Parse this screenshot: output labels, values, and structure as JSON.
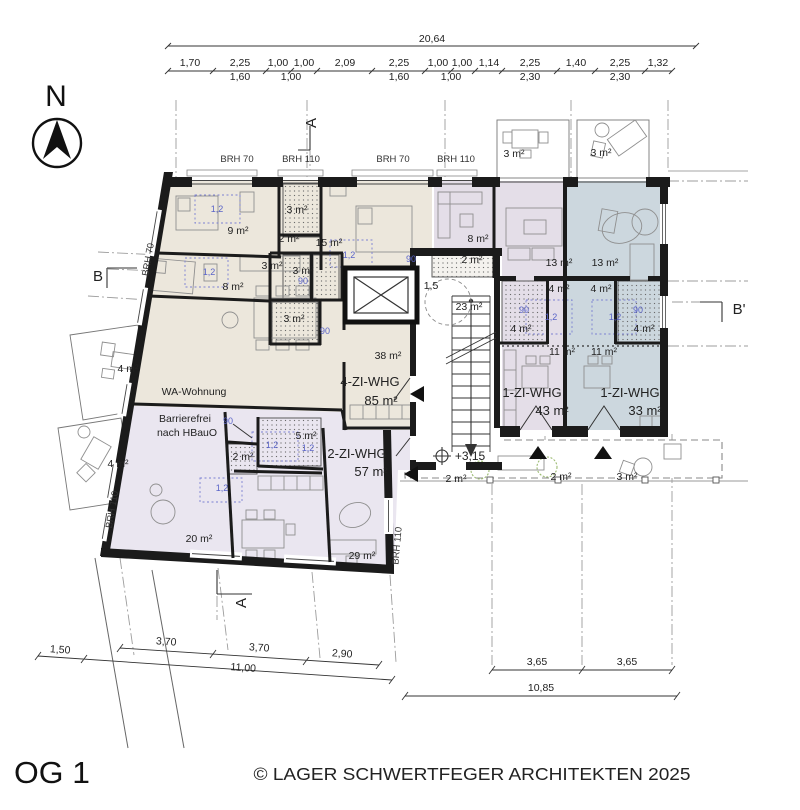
{
  "meta": {
    "drawing_title": "OG 1",
    "copyright": "© LAGER SCHWERTFEGER ARCHITEKTEN 2025",
    "plan_type": "floor-plan"
  },
  "colors": {
    "apartment_beige": "#ece7dc",
    "apartment_lavender": "#eae6f0",
    "apartment_purple": "#e4dee8",
    "apartment_blue": "#ccd7de",
    "annotation_blue": "#5a64c8",
    "plant_green": "#9cbb72",
    "wall_black": "#1b1b1b"
  },
  "apartments": [
    {
      "name": "4-ZI-WHG",
      "area": "85 m²"
    },
    {
      "name": "2-ZI-WHG",
      "area": "57 m²"
    },
    {
      "name": "1-ZI-WHG",
      "area": "43 m²"
    },
    {
      "name": "1-ZI-WHG",
      "area": "33 m²"
    },
    {
      "name": "WA-Wohnung",
      "note": "Barrierefrei nach HBauO"
    }
  ],
  "labels": [
    {
      "t": "20,64",
      "x": 432,
      "y": 42,
      "k": "dim",
      "n": "dim-top-overall"
    },
    {
      "t": "1,70",
      "x": 190,
      "y": 66,
      "k": "dim",
      "n": "dim-top"
    },
    {
      "t": "2,25",
      "x": 240,
      "y": 66,
      "k": "dim",
      "n": "dim-top"
    },
    {
      "t": "1,00",
      "x": 278,
      "y": 66,
      "k": "dim",
      "n": "dim-top"
    },
    {
      "t": "1,00",
      "x": 304,
      "y": 66,
      "k": "dim",
      "n": "dim-top"
    },
    {
      "t": "2,09",
      "x": 345,
      "y": 66,
      "k": "dim",
      "n": "dim-top"
    },
    {
      "t": "2,25",
      "x": 399,
      "y": 66,
      "k": "dim",
      "n": "dim-top"
    },
    {
      "t": "1,00",
      "x": 438,
      "y": 66,
      "k": "dim",
      "n": "dim-top"
    },
    {
      "t": "1,00",
      "x": 462,
      "y": 66,
      "k": "dim",
      "n": "dim-top"
    },
    {
      "t": "1,14",
      "x": 489,
      "y": 66,
      "k": "dim",
      "n": "dim-top"
    },
    {
      "t": "2,25",
      "x": 530,
      "y": 66,
      "k": "dim",
      "n": "dim-top"
    },
    {
      "t": "1,40",
      "x": 576,
      "y": 66,
      "k": "dim",
      "n": "dim-top"
    },
    {
      "t": "2,25",
      "x": 620,
      "y": 66,
      "k": "dim",
      "n": "dim-top"
    },
    {
      "t": "1,32",
      "x": 658,
      "y": 66,
      "k": "dim",
      "n": "dim-top"
    },
    {
      "t": "1,60",
      "x": 240,
      "y": 80,
      "k": "dim",
      "n": "dim-top-sub"
    },
    {
      "t": "1,00",
      "x": 291,
      "y": 80,
      "k": "dim",
      "n": "dim-top-sub"
    },
    {
      "t": "1,60",
      "x": 399,
      "y": 80,
      "k": "dim",
      "n": "dim-top-sub"
    },
    {
      "t": "1,00",
      "x": 451,
      "y": 80,
      "k": "dim",
      "n": "dim-top-sub"
    },
    {
      "t": "2,30",
      "x": 530,
      "y": 80,
      "k": "dim",
      "n": "dim-top-sub"
    },
    {
      "t": "2,30",
      "x": 620,
      "y": 80,
      "k": "dim",
      "n": "dim-top-sub"
    },
    {
      "t": "3,70",
      "x": 166,
      "y": 645,
      "k": "dim",
      "r": 4,
      "n": "dim-bottom-left"
    },
    {
      "t": "3,70",
      "x": 259,
      "y": 651,
      "k": "dim",
      "r": 4,
      "n": "dim-bottom-left"
    },
    {
      "t": "2,90",
      "x": 342,
      "y": 657,
      "k": "dim",
      "r": 4,
      "n": "dim-bottom-left"
    },
    {
      "t": "1,50",
      "x": 60,
      "y": 653,
      "k": "dim",
      "r": 4,
      "n": "dim-bottom-left"
    },
    {
      "t": "11,00",
      "x": 243,
      "y": 671,
      "k": "dim",
      "r": 4,
      "n": "dim-bottom-left-overall"
    },
    {
      "t": "3,65",
      "x": 537,
      "y": 665,
      "k": "dim",
      "n": "dim-bottom-right"
    },
    {
      "t": "3,65",
      "x": 627,
      "y": 665,
      "k": "dim",
      "n": "dim-bottom-right"
    },
    {
      "t": "10,85",
      "x": 541,
      "y": 691,
      "k": "dim",
      "n": "dim-bottom-right-overall"
    },
    {
      "t": "N",
      "x": 56,
      "y": 106,
      "k": "north",
      "n": "north-label"
    },
    {
      "t": "A",
      "x": 316,
      "y": 123,
      "k": "marker",
      "r": -90,
      "n": "section-marker-a-top"
    },
    {
      "t": "A",
      "x": 246,
      "y": 603,
      "k": "marker",
      "r": -90,
      "n": "section-marker-a-bottom"
    },
    {
      "t": "B",
      "x": 98,
      "y": 281,
      "k": "marker",
      "n": "section-marker-b"
    },
    {
      "t": "B'",
      "x": 739,
      "y": 314,
      "k": "marker",
      "n": "section-marker-b-prime"
    },
    {
      "t": "BRH 70",
      "x": 237,
      "y": 162,
      "k": "brh",
      "n": "sill-height-label"
    },
    {
      "t": "BRH 110",
      "x": 301,
      "y": 162,
      "k": "brh",
      "n": "sill-height-label"
    },
    {
      "t": "BRH 70",
      "x": 393,
      "y": 162,
      "k": "brh",
      "n": "sill-height-label"
    },
    {
      "t": "BRH 110",
      "x": 456,
      "y": 162,
      "k": "brh",
      "n": "sill-height-label"
    },
    {
      "t": "BRH 70",
      "x": 151,
      "y": 260,
      "k": "brh",
      "r": -80,
      "n": "sill-height-label"
    },
    {
      "t": "BRH 110",
      "x": 115,
      "y": 510,
      "k": "brh",
      "r": -80,
      "n": "sill-height-label"
    },
    {
      "t": "BRH 110",
      "x": 400,
      "y": 546,
      "k": "brh",
      "r": -85,
      "n": "sill-height-label"
    },
    {
      "t": "9 m²",
      "x": 238,
      "y": 234,
      "k": "room",
      "n": "room-area"
    },
    {
      "t": "3 m²",
      "x": 297,
      "y": 213,
      "k": "room",
      "n": "room-area"
    },
    {
      "t": "2 m²",
      "x": 289,
      "y": 242,
      "k": "room",
      "n": "room-area"
    },
    {
      "t": "15 m²",
      "x": 329,
      "y": 246,
      "k": "room",
      "n": "room-area"
    },
    {
      "t": "3 m²",
      "x": 272,
      "y": 269,
      "k": "room",
      "n": "room-area"
    },
    {
      "t": "3 m²",
      "x": 303,
      "y": 274,
      "k": "room",
      "n": "room-area"
    },
    {
      "t": "8 m²",
      "x": 233,
      "y": 290,
      "k": "room",
      "n": "room-area"
    },
    {
      "t": "3 m²",
      "x": 294,
      "y": 322,
      "k": "room",
      "n": "room-area"
    },
    {
      "t": "38 m²",
      "x": 388,
      "y": 359,
      "k": "room",
      "n": "room-area"
    },
    {
      "t": "23 m²",
      "x": 469,
      "y": 310,
      "k": "room",
      "n": "room-area"
    },
    {
      "t": "1,5",
      "x": 431,
      "y": 289,
      "k": "room",
      "n": "turning-radius-label"
    },
    {
      "t": "2 m²",
      "x": 472,
      "y": 263,
      "k": "room",
      "n": "room-area"
    },
    {
      "t": "8 m²",
      "x": 478,
      "y": 242,
      "k": "room",
      "n": "room-area"
    },
    {
      "t": "13 m²",
      "x": 559,
      "y": 266,
      "k": "room",
      "n": "room-area"
    },
    {
      "t": "13 m²",
      "x": 605,
      "y": 266,
      "k": "room",
      "n": "room-area"
    },
    {
      "t": "4 m²",
      "x": 559,
      "y": 292,
      "k": "room",
      "n": "room-area"
    },
    {
      "t": "4 m²",
      "x": 601,
      "y": 292,
      "k": "room",
      "n": "room-area"
    },
    {
      "t": "4 m²",
      "x": 521,
      "y": 332,
      "k": "room",
      "n": "room-area"
    },
    {
      "t": "4 m²",
      "x": 644,
      "y": 332,
      "k": "room",
      "n": "room-area"
    },
    {
      "t": "11 m²",
      "x": 562,
      "y": 355,
      "k": "room",
      "n": "room-area"
    },
    {
      "t": "11 m²",
      "x": 604,
      "y": 355,
      "k": "room",
      "n": "room-area"
    },
    {
      "t": "5 m²",
      "x": 306,
      "y": 439,
      "k": "room",
      "n": "room-area"
    },
    {
      "t": "2 m²",
      "x": 243,
      "y": 460,
      "k": "room",
      "n": "room-area"
    },
    {
      "t": "20 m²",
      "x": 199,
      "y": 542,
      "k": "room",
      "n": "room-area"
    },
    {
      "t": "29 m²",
      "x": 362,
      "y": 559,
      "k": "room",
      "n": "room-area"
    },
    {
      "t": "3 m²",
      "x": 514,
      "y": 157,
      "k": "room",
      "n": "balcony-area"
    },
    {
      "t": "3 m²",
      "x": 601,
      "y": 156,
      "k": "room",
      "n": "balcony-area"
    },
    {
      "t": "4 m²",
      "x": 128,
      "y": 372,
      "k": "room",
      "n": "balcony-area"
    },
    {
      "t": "4 m²",
      "x": 118,
      "y": 467,
      "k": "room",
      "n": "balcony-area"
    },
    {
      "t": "2 m²",
      "x": 456,
      "y": 482,
      "k": "room",
      "n": "walkway-area"
    },
    {
      "t": "2 m²",
      "x": 561,
      "y": 480,
      "k": "room",
      "n": "walkway-area"
    },
    {
      "t": "3 m²",
      "x": 627,
      "y": 480,
      "k": "room",
      "n": "walkway-area"
    },
    {
      "t": "WA-Wohnung",
      "x": 194,
      "y": 395,
      "k": "apt-s",
      "n": "apartment-label-wa"
    },
    {
      "t": "Barrierefrei",
      "x": 185,
      "y": 422,
      "k": "apt-s",
      "n": "barrier-free-note"
    },
    {
      "t": "nach HBauO",
      "x": 187,
      "y": 436,
      "k": "apt-s",
      "n": "barrier-free-note"
    },
    {
      "t": "4-ZI-WHG",
      "x": 370,
      "y": 386,
      "k": "apt",
      "n": "apartment-label"
    },
    {
      "t": "85 m²",
      "x": 381,
      "y": 405,
      "k": "apt",
      "n": "apartment-area"
    },
    {
      "t": "2-ZI-WHG",
      "x": 357,
      "y": 458,
      "k": "apt",
      "n": "apartment-label"
    },
    {
      "t": "57 m²",
      "x": 371,
      "y": 476,
      "k": "apt",
      "n": "apartment-area"
    },
    {
      "t": "1-ZI-WHG",
      "x": 532,
      "y": 397,
      "k": "apt",
      "n": "apartment-label"
    },
    {
      "t": "43 m²",
      "x": 552,
      "y": 415,
      "k": "apt",
      "n": "apartment-area"
    },
    {
      "t": "1-ZI-WHG",
      "x": 630,
      "y": 397,
      "k": "apt",
      "n": "apartment-label"
    },
    {
      "t": "33 m²",
      "x": 645,
      "y": 415,
      "k": "apt",
      "n": "apartment-area"
    },
    {
      "t": "+3,15",
      "x": 470,
      "y": 460,
      "k": "level",
      "n": "level-annotation"
    },
    {
      "t": "1,2",
      "x": 217,
      "y": 212,
      "k": "blue",
      "n": "clearance-label"
    },
    {
      "t": "1,2",
      "x": 209,
      "y": 275,
      "k": "blue",
      "n": "clearance-label"
    },
    {
      "t": "1,2",
      "x": 349,
      "y": 258,
      "k": "blue",
      "n": "clearance-label"
    },
    {
      "t": "90",
      "x": 411,
      "y": 262,
      "k": "blue",
      "n": "door-width-label"
    },
    {
      "t": "90",
      "x": 303,
      "y": 284,
      "k": "blue",
      "n": "door-width-label"
    },
    {
      "t": "90",
      "x": 325,
      "y": 334,
      "k": "blue",
      "n": "door-width-label"
    },
    {
      "t": "90",
      "x": 228,
      "y": 424,
      "k": "blue",
      "n": "door-width-label"
    },
    {
      "t": "90",
      "x": 524,
      "y": 313,
      "k": "blue",
      "n": "door-width-label"
    },
    {
      "t": "90",
      "x": 638,
      "y": 313,
      "k": "blue",
      "n": "door-width-label"
    },
    {
      "t": "1,2",
      "x": 551,
      "y": 320,
      "k": "blue",
      "n": "clearance-label"
    },
    {
      "t": "1,2",
      "x": 615,
      "y": 320,
      "k": "blue",
      "n": "clearance-label"
    },
    {
      "t": "1,2",
      "x": 272,
      "y": 448,
      "k": "blue",
      "n": "clearance-label"
    },
    {
      "t": "1,2",
      "x": 308,
      "y": 451,
      "k": "blue",
      "n": "clearance-label"
    },
    {
      "t": "1,2",
      "x": 222,
      "y": 491,
      "k": "blue",
      "n": "clearance-label"
    },
    {
      "t": "OG 1",
      "x": 52,
      "y": 783,
      "k": "title",
      "a": "start",
      "len": 76,
      "n": "page-title"
    },
    {
      "t": "© LAGER SCHWERTFEGER ARCHITEKTEN 2025",
      "x": 472,
      "y": 780,
      "k": "copy",
      "len": 437,
      "n": "copyright"
    }
  ]
}
